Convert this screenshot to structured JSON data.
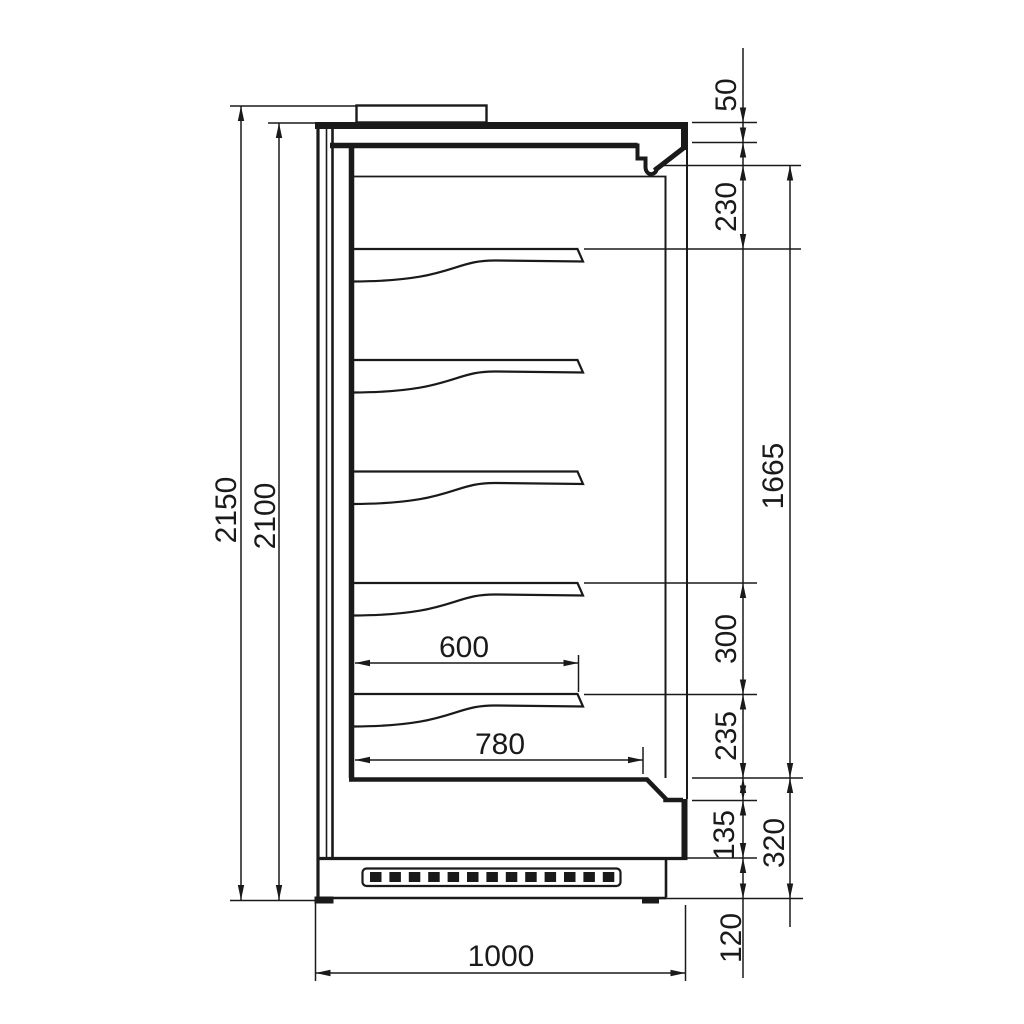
{
  "drawing": {
    "kind": "technical-dimension-drawing",
    "subject": "refrigerated-display-cabinet-side-section",
    "units_implied": "mm",
    "line_color": "#1a1a1a",
    "background_color": "#ffffff"
  },
  "dims": {
    "overall_height": {
      "label": "2150",
      "orientation": "vertical",
      "side": "left"
    },
    "cabinet_height": {
      "label": "2100",
      "orientation": "vertical",
      "side": "left"
    },
    "top_spacer": {
      "label": "50",
      "orientation": "vertical",
      "side": "right"
    },
    "canopy_section": {
      "label": "230",
      "orientation": "vertical",
      "side": "right"
    },
    "display_opening": {
      "label": "1665",
      "orientation": "vertical",
      "side": "right"
    },
    "shelf_pitch": {
      "label": "300",
      "orientation": "vertical",
      "side": "right"
    },
    "shelf_to_deck": {
      "label": "235",
      "orientation": "vertical",
      "side": "right"
    },
    "bumper_section": {
      "label": "135",
      "orientation": "vertical",
      "side": "right"
    },
    "base_section": {
      "label": "320",
      "orientation": "vertical",
      "side": "right"
    },
    "plinth_height": {
      "label": "120",
      "orientation": "vertical",
      "side": "right"
    },
    "shelf_depth": {
      "label": "600",
      "orientation": "horizontal",
      "side": "inner"
    },
    "deck_depth": {
      "label": "780",
      "orientation": "horizontal",
      "side": "inner"
    },
    "overall_depth": {
      "label": "1000",
      "orientation": "horizontal",
      "side": "bottom"
    }
  }
}
